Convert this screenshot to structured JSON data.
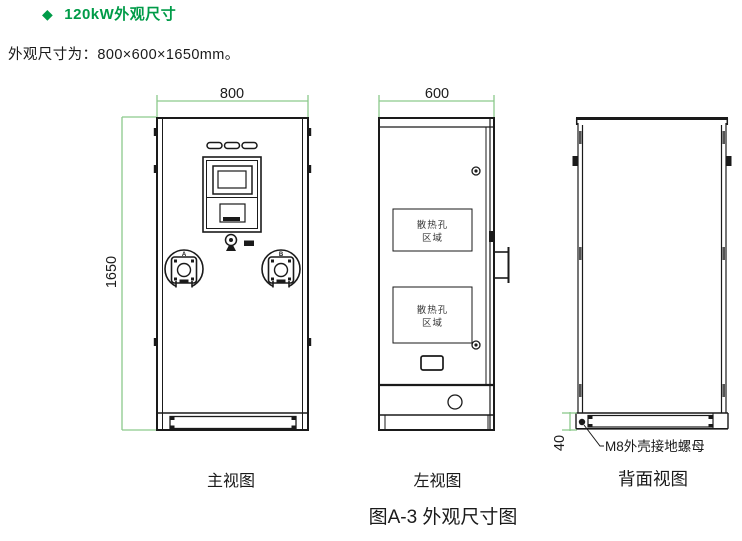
{
  "header": {
    "bullet": "◆",
    "title": "120kW外观尺寸"
  },
  "intro": {
    "text": "外观尺寸为：800×600×1650mm。"
  },
  "figure": {
    "caption": "图A-3 外观尺寸图",
    "views": {
      "front": {
        "label": "主视图",
        "width_dim": "800",
        "height_dim": "1650",
        "gun_a_label": "A",
        "gun_b_label": "B"
      },
      "left": {
        "label": "左视图",
        "width_dim": "600",
        "vent_area_1": {
          "line1": "散热孔",
          "line2": "区域"
        },
        "vent_area_2": {
          "line1": "散热孔",
          "line2": "区域"
        }
      },
      "back": {
        "label": "背面视图",
        "ground_height_dim": "40",
        "ground_nut_label": "M8外壳接地螺母"
      }
    },
    "colors": {
      "accent_green": "#009B48",
      "dimension_line_green": "#8CC98C",
      "drawing_line": "#1A1A1A"
    }
  }
}
